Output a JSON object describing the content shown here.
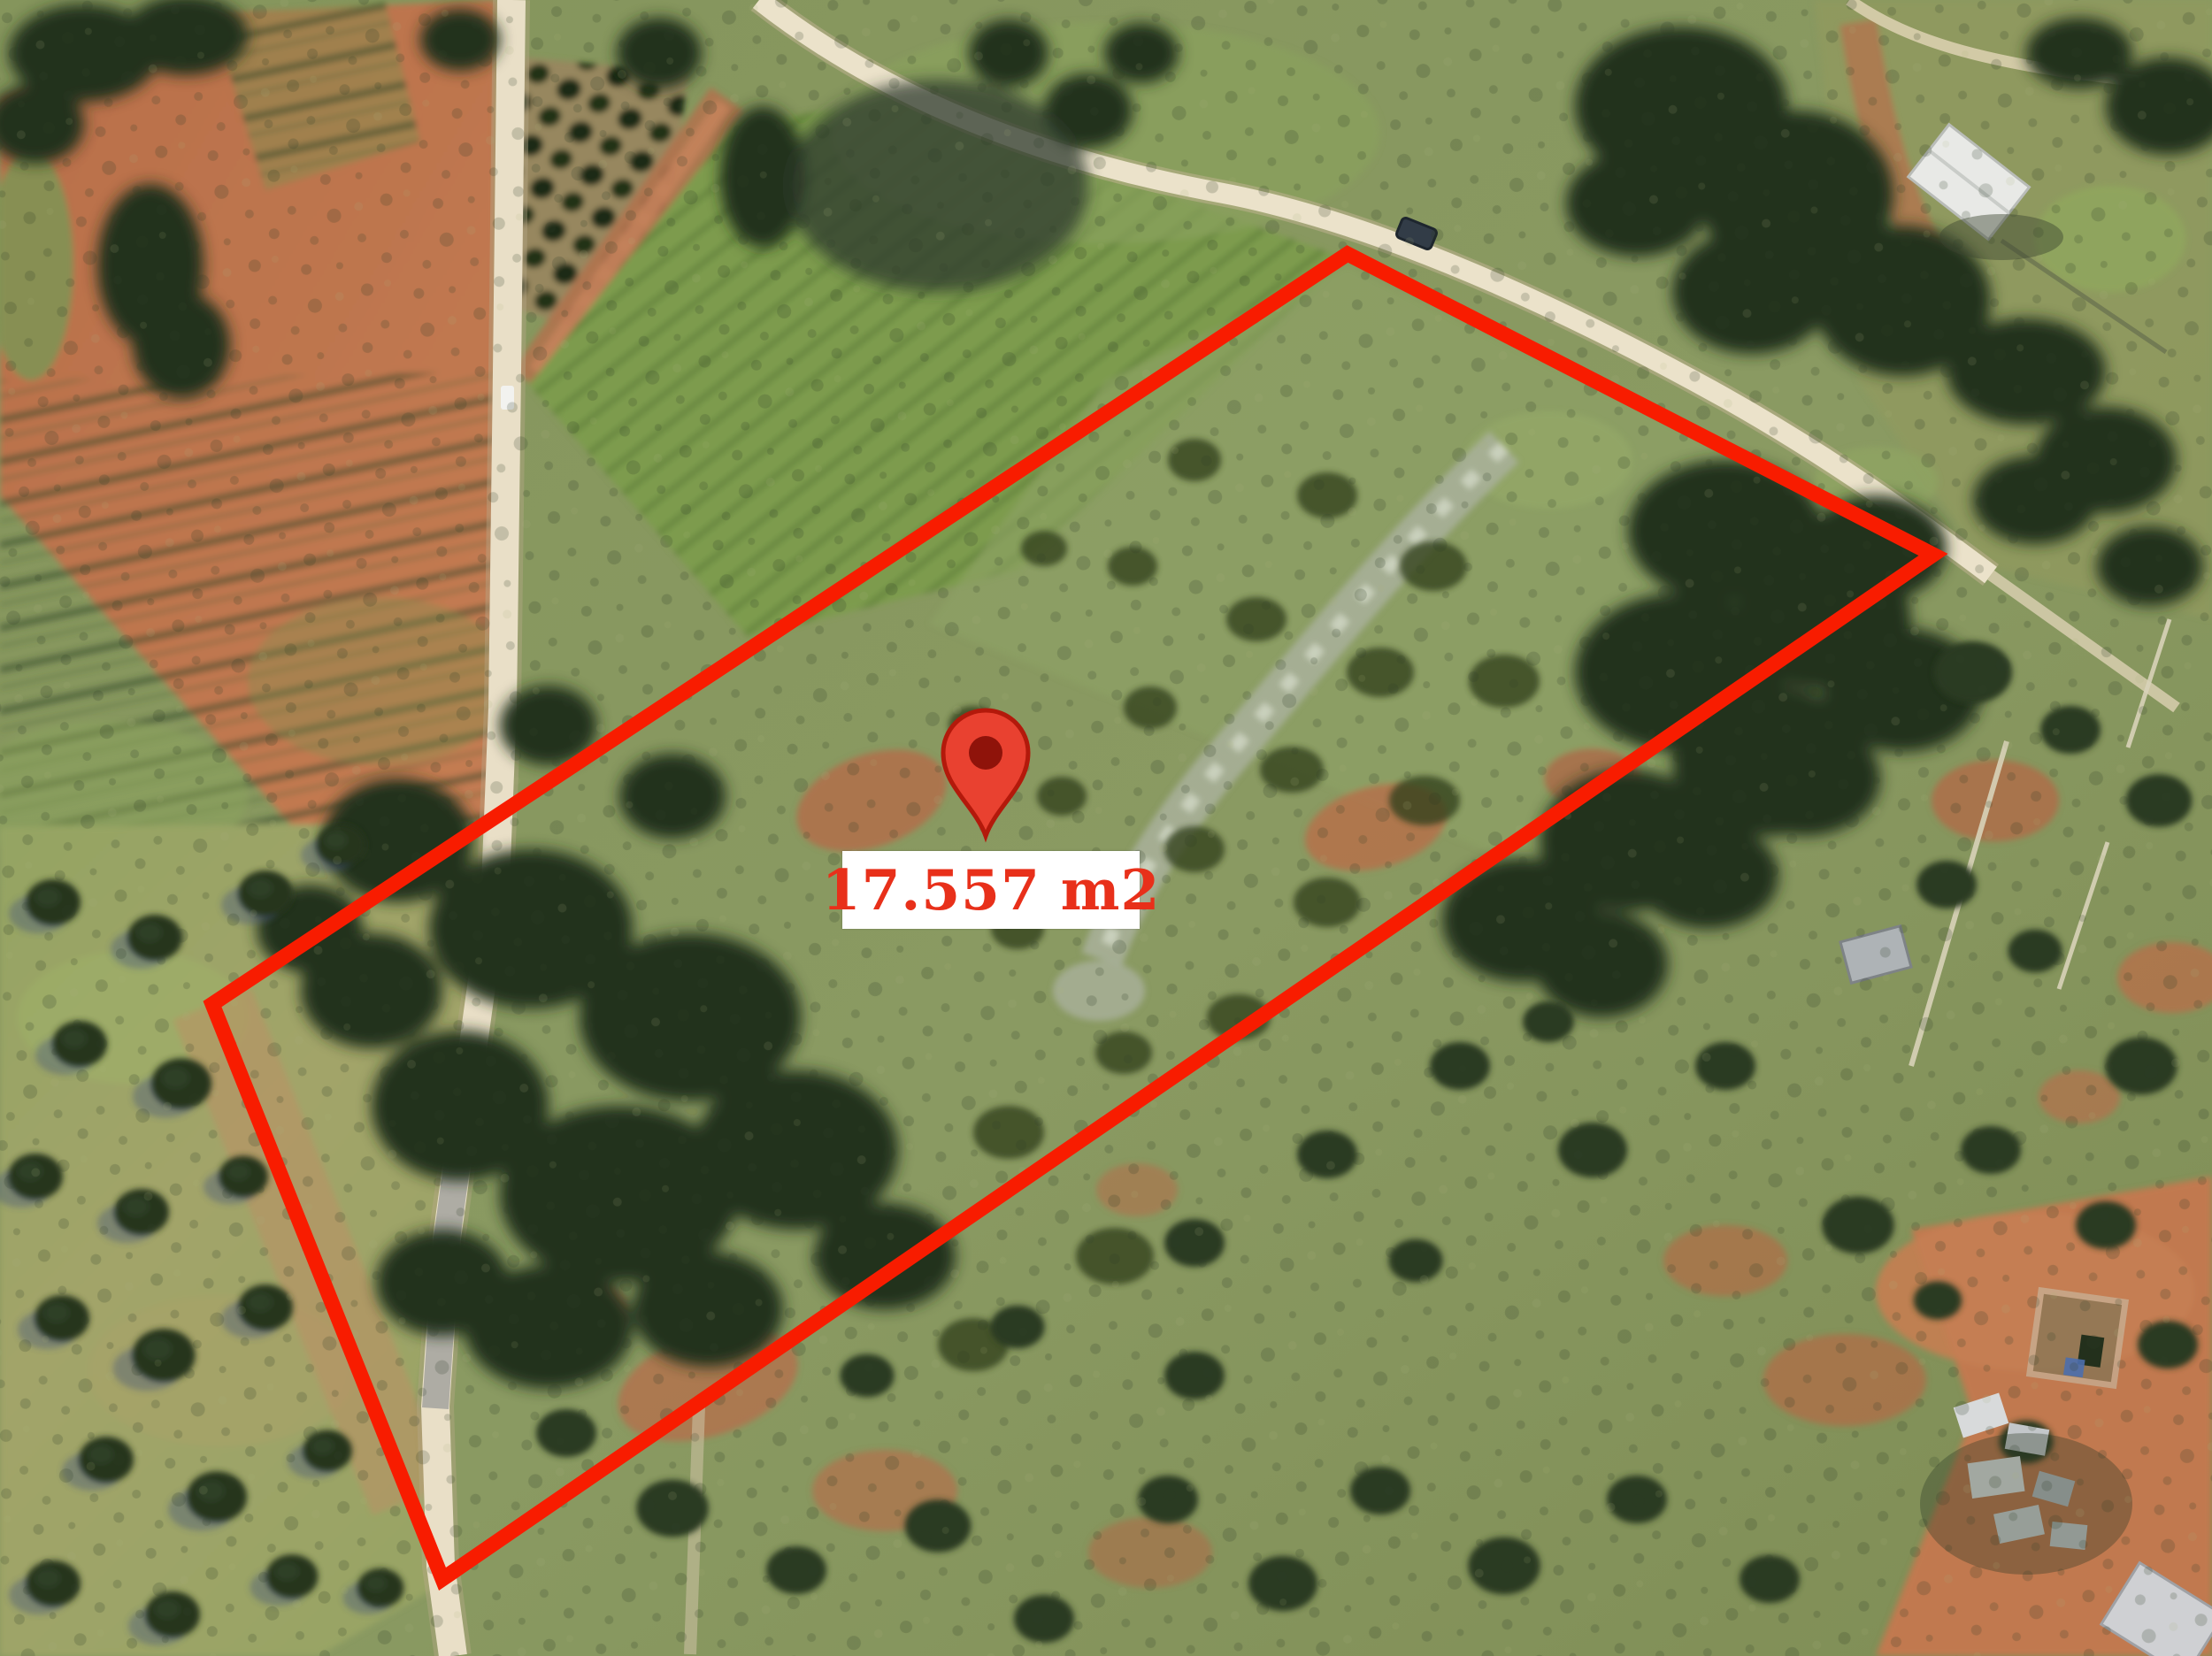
{
  "map": {
    "view": "aerial-satellite-photo",
    "area_label": {
      "text": "17.557 m2",
      "text_color": "#e8301a",
      "background_color": "#ffffff"
    },
    "parcel": {
      "polygon_points": "1523,287 2185,627 500,1785 240,1135",
      "outline_color": "#f81c00",
      "outline_width": 17
    },
    "marker": {
      "transform": "translate(1114,945)",
      "fill": "#e94130",
      "border": "#b3190b",
      "dot": "#8f130a"
    }
  }
}
